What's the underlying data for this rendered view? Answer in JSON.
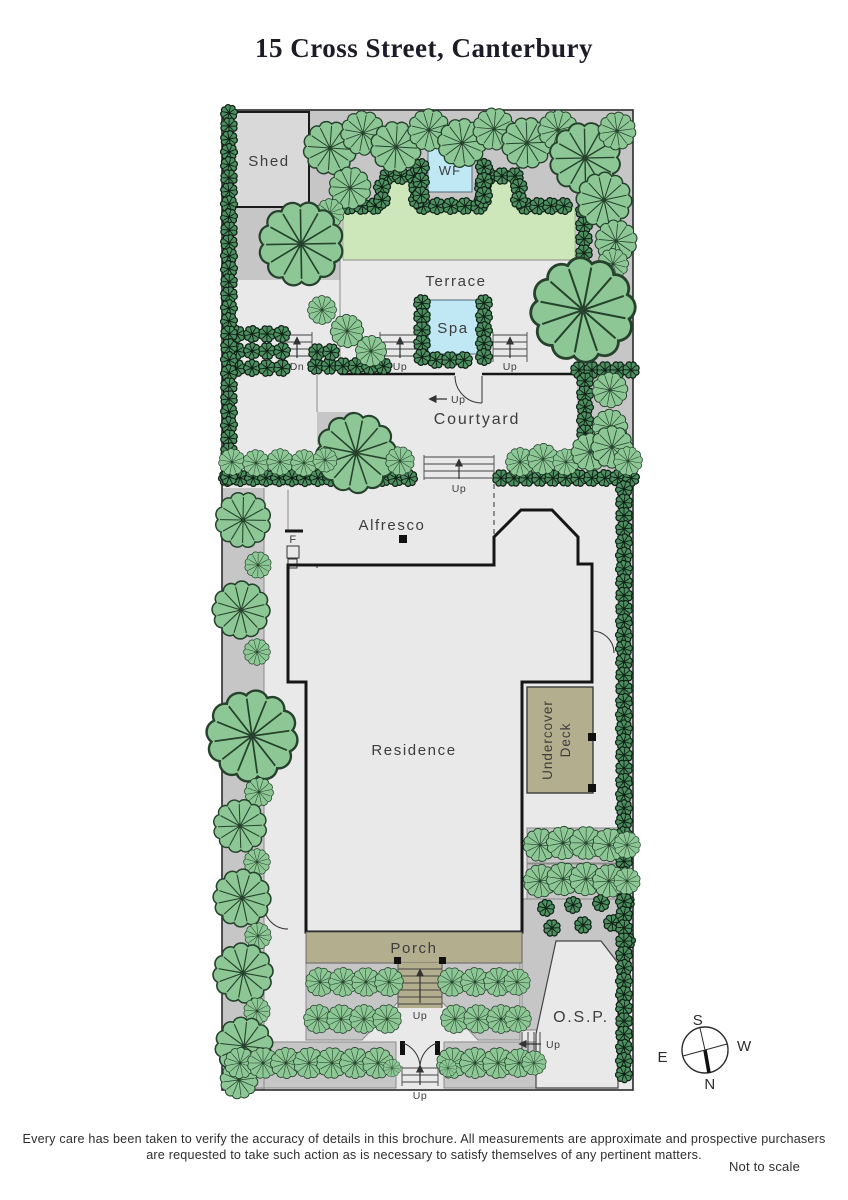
{
  "title": "15 Cross Street, Canterbury",
  "plan": {
    "areas": {
      "shed": "Shed",
      "water_feature": "WF",
      "terrace": "Terrace",
      "spa": "Spa",
      "courtyard": "Courtyard",
      "alfresco": "Alfresco",
      "fireplace": "F",
      "residence": "Residence",
      "undercover_deck_line1": "Undercover",
      "undercover_deck_line2": "Deck",
      "porch": "Porch",
      "osp": "O.S.P."
    },
    "steps": {
      "up": "Up",
      "dn": "Dn"
    },
    "compass": {
      "north": "N",
      "south": "S",
      "east": "E",
      "west": "W"
    },
    "colors": {
      "paving": "#c6c6c6",
      "path": "#e9e9e9",
      "lawn": "#cde7ba",
      "water": "#bfe7f4",
      "timber": "#b3ae8e",
      "residence": "#d4d4d4",
      "shed": "#d9d9d9",
      "tree": "#8cc795",
      "hedge": "#4d8f60"
    }
  },
  "footer": {
    "disclaimer_line1": "Every care has been taken to verify the accuracy of details in this brochure.  All measurements are approximate and prospective purchasers",
    "disclaimer_line2": "are requested to take such action as is necessary to satisfy themselves of any pertinent matters.",
    "scale_note": "Not to scale"
  }
}
